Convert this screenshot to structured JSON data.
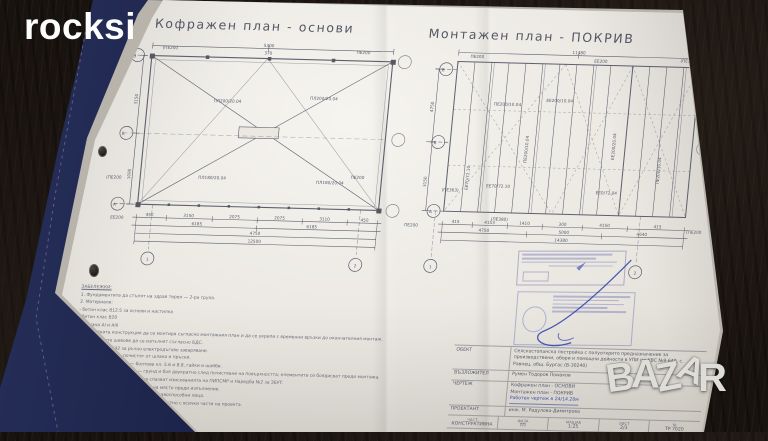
{
  "watermarks": {
    "site": "rocksi",
    "marketplace": {
      "p1": "B",
      "p2": "A",
      "p3": "Z",
      "p4": "A",
      "p5": "R"
    }
  },
  "sheet": {
    "titles": {
      "left": "Кофражен план - основи",
      "right": "Монтажен план - ПОКРИВ"
    },
    "plans": {
      "left": {
        "axes": {
          "rows": [
            "В",
            "Б",
            "А"
          ],
          "cols": [
            "1",
            "2"
          ]
        },
        "labels": {
          "pe200": "ПЕ200",
          "pe200_p": "(ПЕ200",
          "ee200": "ЕЕ200",
          "slab_top": "ПЛ200/20.04",
          "slab_bottom": "ПЛ180/20.04"
        },
        "dims_top": [
          "5300",
          "370"
        ],
        "dims_left": [
          "3150",
          "1090"
        ],
        "dims_b1": [
          "450",
          "3150",
          "2075",
          "2075",
          "3110",
          "450"
        ],
        "dims_b2": [
          "6185",
          "6185"
        ],
        "dims_b3": [
          "4750"
        ],
        "dims_b4": [
          "12500"
        ]
      },
      "right": {
        "axes": {
          "rows": [
            "В",
            "Б",
            "А"
          ],
          "cols": [
            "1",
            "2"
          ]
        },
        "labels": {
          "pe200": "ПЕ200",
          "pe200_p": "(ПЕ200",
          "ee200": "ЕЕ200",
          "panel_a": "ПЕ200/10.04",
          "panel_b": "ЕЕ200/10.04",
          "panel_c": "ЕЕ200/20.04",
          "box_a": "ЕЕ70/72.10",
          "box_b": "ЕЕ0/72.04",
          "pe363": "(ПЕ363)",
          "pe380": "(ПЕ380)"
        },
        "dims_top": [
          "11380"
        ],
        "dims_left": [
          "4750",
          "3150"
        ],
        "dims_b1": [
          "415",
          "4153",
          "1410",
          "300",
          "4150",
          "415"
        ],
        "dims_b2": [
          "4750",
          "5000",
          "4640"
        ],
        "dims_b3": [
          "14380"
        ]
      }
    },
    "notes": [
      "ЗАБЕЛЕЖКИ:",
      "1. Фундаментите да стъпят на здрав терен — 2-ра група.",
      "2. Материали:",
      "   - бетон клас В12.5 за основи и настилка",
      "   - бетон клас В20",
      "   - стомана АI и АIII",
      "3. Покривната конструкция да се монтира съгласно монтажния план и да се укрепи с временни връзки до окончателния монтаж.",
      "4. Заваръчните шевове да се изпълнят съгласно БДС.",
      "4.1. Електроди Е42 за ръчно електродъгово заваряване.",
      "4.2. Шевовете да се почистят от шлака и пръски.",
      "5. Болтови съединения — болтове кл. 5.6 и 8.8, гайки и шайби.",
      "6. Антикорозионна защита — грунд и боя двукратно след почистване на повърхността; елементите се боядисват преди монтажа.",
      "7. При изпълнение на СМР да се спазват изискванията на ПИПСМР и Наредба №2 за ЗБУТ.",
      "8. Всички размери да се проверят на място преди изпълнение.",
      "9. Конструкцията да се изпълни от правоспособни лица.",
      "10. Настоящият чертеж да се чете съвместно с всички части на проекта."
    ],
    "title_block": {
      "rows": {
        "obekt": {
          "label": "ОБЕКТ",
          "value": "Селскостопанска постройка с полуоткрито предназначение за производствени, обори и помощни дейности в УПИ по КВС №9-640, с. Равнец, общ. Бургас (В-30240)"
        },
        "vazlozhitel": {
          "label": "ВЪЗЛОЖИТЕЛ",
          "value": "Румен Тодоров Помаков"
        },
        "chertezh": {
          "label": "ЧЕРТЕЖ",
          "lines": [
            "Кофражен план - ОСНОВИ",
            "Монтажен план - ПОКРИВ",
            "Работен чертеж в 24/14.20м"
          ]
        },
        "proektant": {
          "label": "ПРОЕКТАНТ",
          "value": "инж. М. Радулова-Димитрова"
        }
      },
      "cells": [
        {
          "k": "ЧАСТ",
          "v": "КОНСТРУКТИВНА"
        },
        {
          "k": "ФАЗА",
          "v": "ТП"
        },
        {
          "k": "МАЩАБ",
          "v": "1:25"
        },
        {
          "k": "ЛИСТ",
          "v": "2/3"
        },
        {
          "k": "№",
          "v": "ТР 7020"
        }
      ]
    }
  }
}
